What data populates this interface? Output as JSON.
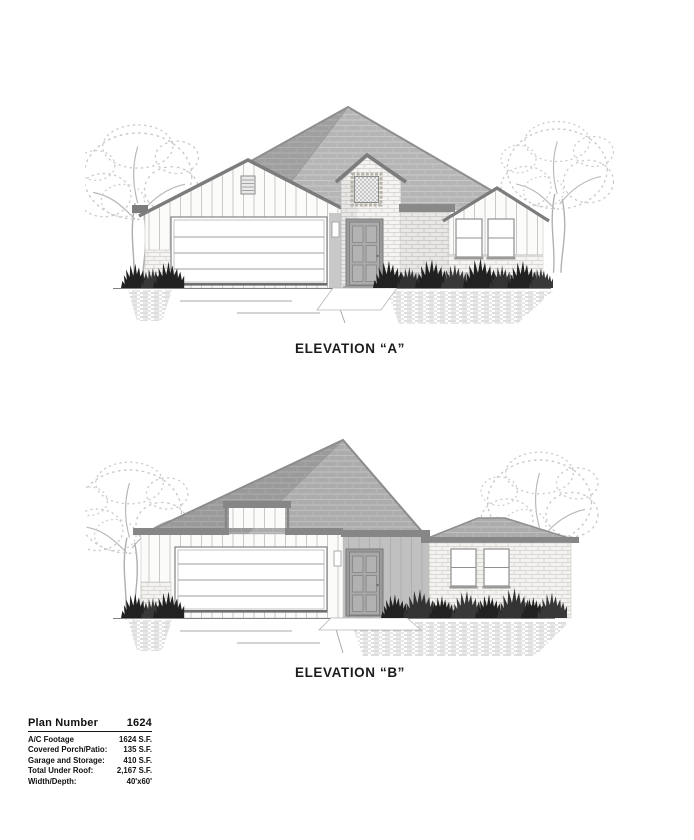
{
  "elevations": [
    {
      "id": "A",
      "label": "ELEVATION “A”"
    },
    {
      "id": "B",
      "label": "ELEVATION “B”"
    }
  ],
  "spec_table": {
    "title": "Plan Number",
    "title_value": "1624",
    "rows": [
      {
        "label": "A/C Footage",
        "value": "1624 S.F."
      },
      {
        "label": "Covered Porch/Patio:",
        "value": "135 S.F."
      },
      {
        "label": "Garage and Storage:",
        "value": "410 S.F."
      },
      {
        "label": "Total Under Roof:",
        "value": "2,167 S.F."
      },
      {
        "label": "Width/Depth:",
        "value": "40'x60'"
      }
    ]
  },
  "colors": {
    "trim_dark": "#7c7c7c",
    "roof_fill_a": "#b5b5b5",
    "roof_fill_b": "#acacac",
    "bush_fill": "#212121",
    "text": "#1c1c1c"
  }
}
